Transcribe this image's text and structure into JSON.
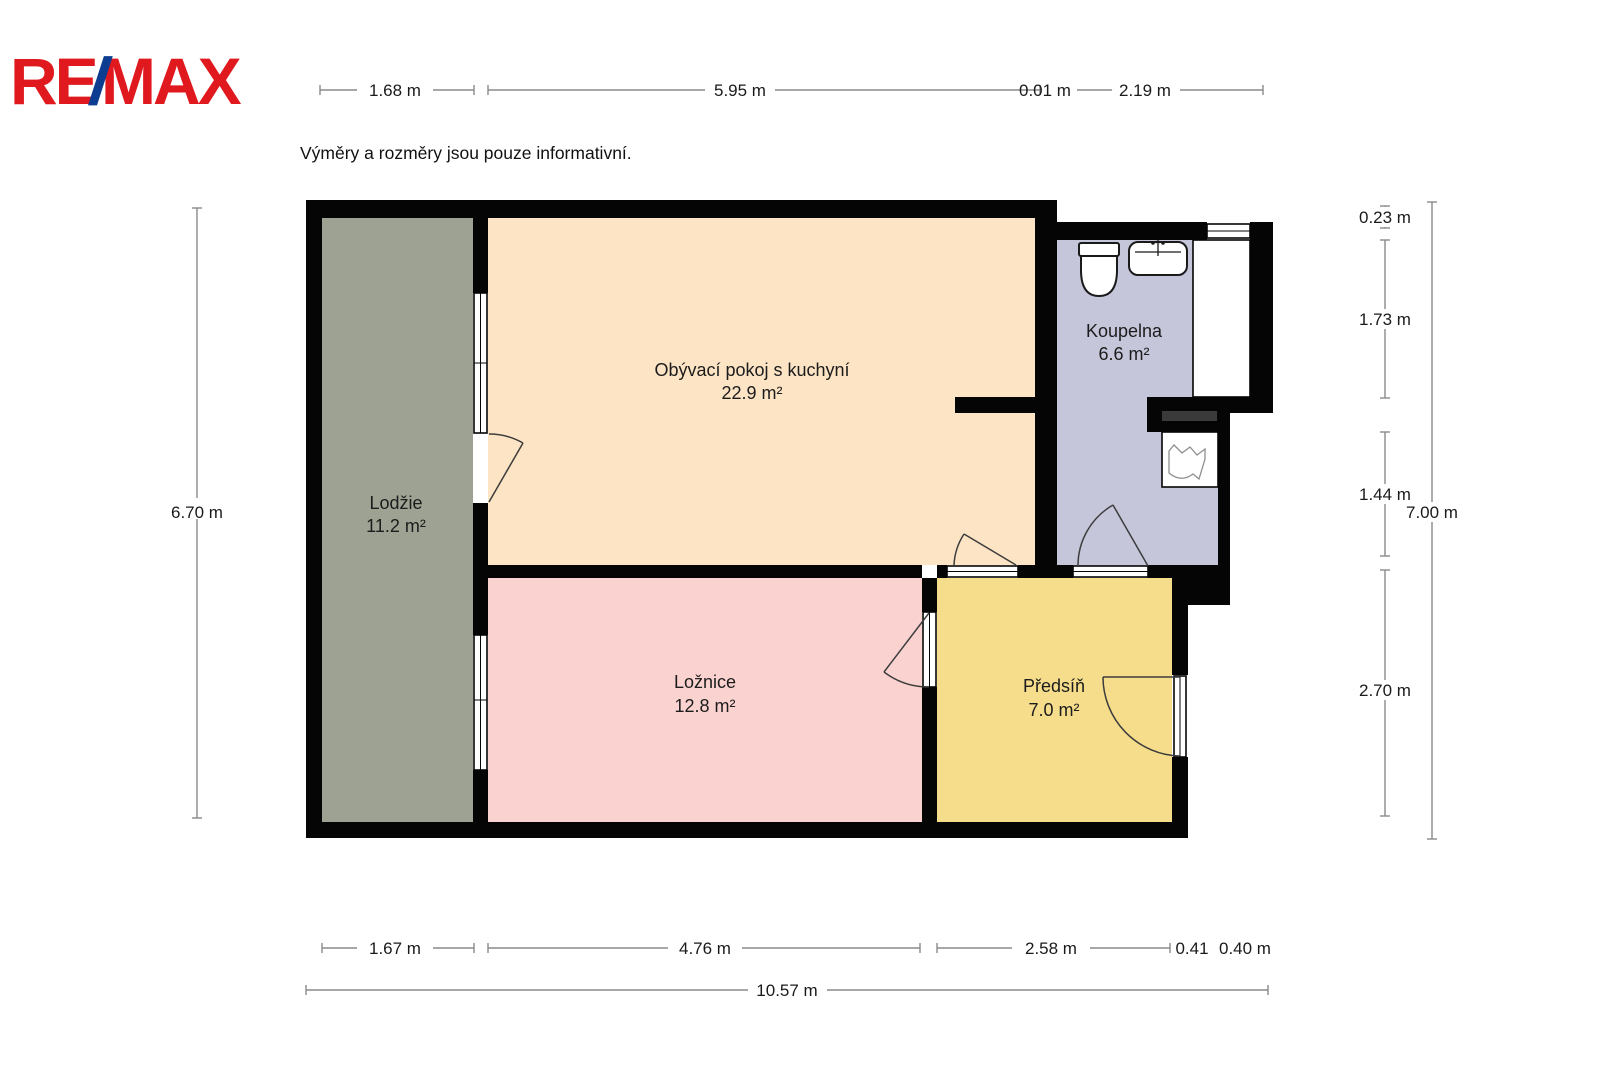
{
  "logo": {
    "part1": "RE",
    "slash": "/",
    "part2": "MAX",
    "red": "#e0191f",
    "blue": "#0d3d91"
  },
  "disclaimer": "Výměry a rozměry jsou pouze informativní.",
  "rooms": [
    {
      "name": "Obývací pokoj s kuchyní",
      "area": "22.9 m²",
      "color": "#fce4c5"
    },
    {
      "name": "Koupelna",
      "area": "6.6 m²",
      "color": "#c6c6da"
    },
    {
      "name": "Lodžie",
      "area": "11.2 m²",
      "color": "#9ea292"
    },
    {
      "name": "Ložnice",
      "area": "12.8 m²",
      "color": "#fad3d0"
    },
    {
      "name": "Předsíň",
      "area": "7.0 m²",
      "color": "#f6dd8c"
    }
  ],
  "dimensions": {
    "top": [
      "1.68 m",
      "5.95 m",
      "0.01 m",
      "2.19 m"
    ],
    "bottom": [
      "1.67 m",
      "4.76 m",
      "2.58 m",
      "0.41",
      "0.40 m"
    ],
    "bottom_total": "10.57 m",
    "left": "6.70 m",
    "right": [
      "0.23 m",
      "1.73 m",
      "1.44 m",
      "2.70 m"
    ],
    "right_total": "7.00 m"
  }
}
